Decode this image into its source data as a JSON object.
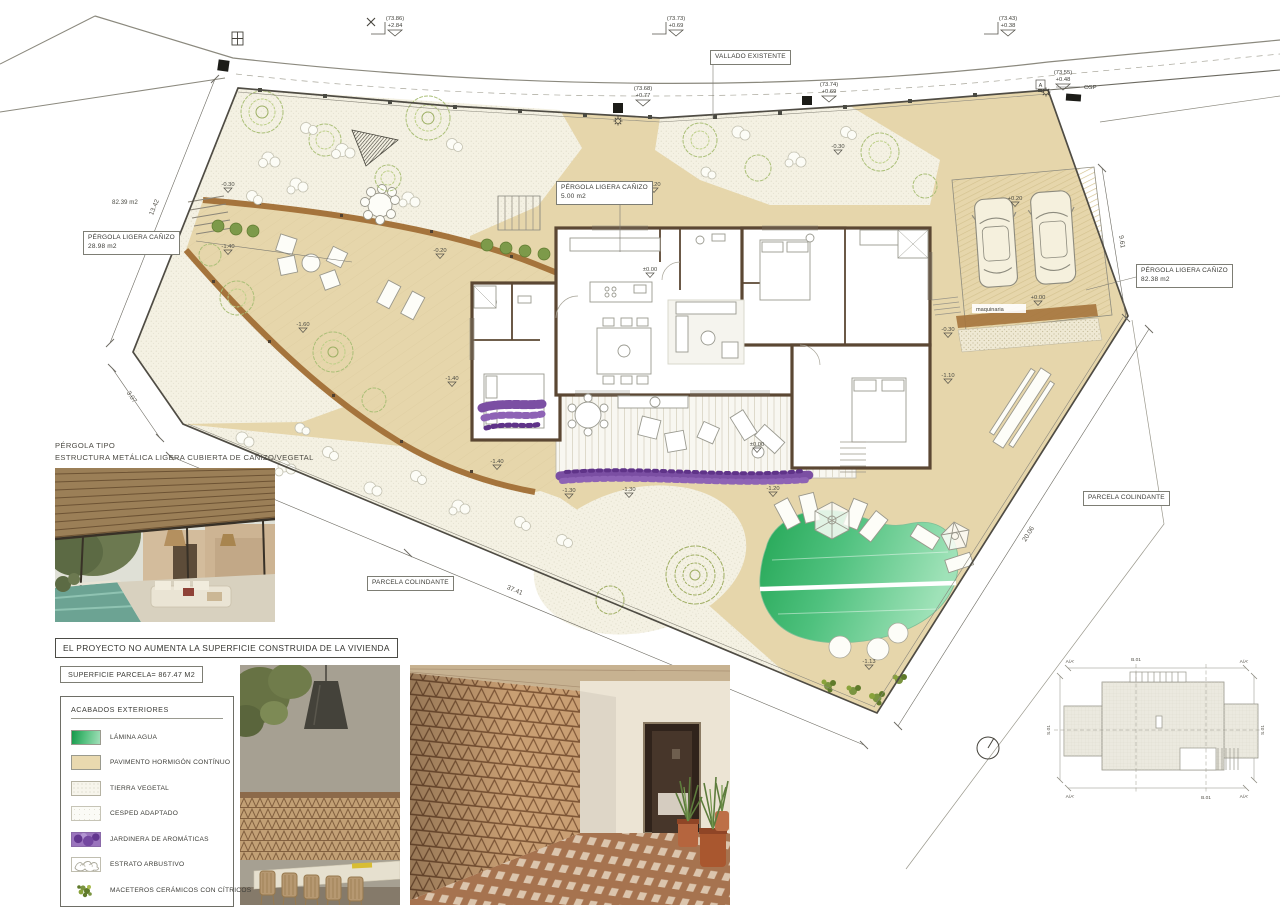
{
  "plan": {
    "labels": {
      "vallado": "VALLADO EXISTENTE",
      "pergola5_l1": "PÉRGOLA LIGERA CAÑIZO",
      "pergola5_l2": "5.00 m2",
      "pergola28_l1": "PÉRGOLA LIGERA CAÑIZO",
      "pergola28_l2": "28.98 m2",
      "pergola82_l1": "PÉRGOLA LIGERA CAÑIZO",
      "pergola82_l2": "82.38 m2",
      "parcela_left": "PARCELA COLINDANTE",
      "parcela_right": "PARCELA COLINDANTE",
      "area_left": "82.39 m2",
      "cgp": "CGP",
      "box_a": "A",
      "maquinaria": "maquinaria"
    },
    "benchmarks": [
      {
        "ref": "(73.86)",
        "val": "+2.84"
      },
      {
        "ref": "(73.73)",
        "val": "+0.69"
      },
      {
        "ref": "(73.43)",
        "val": "+0.38"
      },
      {
        "ref": "(73.68)",
        "val": "+0.77"
      },
      {
        "ref": "(73.74)",
        "val": "+0.69"
      },
      {
        "ref": "(73.55)",
        "val": "+0.48"
      }
    ],
    "spot_levels": [
      "-0.30",
      "-1.40",
      "-0.20",
      "-0.30",
      "-0.20",
      "-1.60",
      "-1.40",
      "-1.40",
      "-1.30",
      "-1.30",
      "-1.20",
      "±0.00",
      "±0.00",
      "-0.30",
      "-1.10",
      "+0.20",
      "+0.00",
      "-1.13"
    ],
    "dimensions": [
      "13.42",
      "3.07",
      "37.41",
      "20.06",
      "9.61"
    ]
  },
  "notes": {
    "pergola_title": "PÉRGOLA TIPO",
    "pergola_desc": "ESTRUCTURA METÁLICA LIGERA CUBIERTA DE CAÑIZO/VEGETAL"
  },
  "statement": "EL PROYECTO NO AUMENTA LA SUPERFICIE CONSTRUIDA DE LA VIVIENDA",
  "surface": "SUPERFICIE PARCELA= 867.47 M2",
  "legend": {
    "title": "ACABADOS  EXTERIORES",
    "items": [
      {
        "label": "LÁMINA AGUA"
      },
      {
        "label": "PAVIMENTO HORMIGÓN CONTÍNUO"
      },
      {
        "label": "TIERRA VEGETAL"
      },
      {
        "label": "CESPED ADAPTADO"
      },
      {
        "label": "JARDINERA  DE AROMÁTICAS"
      },
      {
        "label": "ESTRATO ARBUSTIVO"
      },
      {
        "label": "MACETEROS CERÁMICOS CON CÍTRICOS"
      }
    ]
  },
  "keyplan": {
    "corner": "A/A'",
    "side": "S.01",
    "axis": "B.01"
  },
  "colors": {
    "pavement": "#e6d6ab",
    "earth": "#f4f1e3",
    "pool_dark": "#21a854",
    "pool_light": "#a9e4bf",
    "wall_brown": "#5b4733",
    "wood_brown": "#a5743c",
    "aromatics_purple": "#7b4fa3",
    "tree_green": "#a9bc72"
  }
}
